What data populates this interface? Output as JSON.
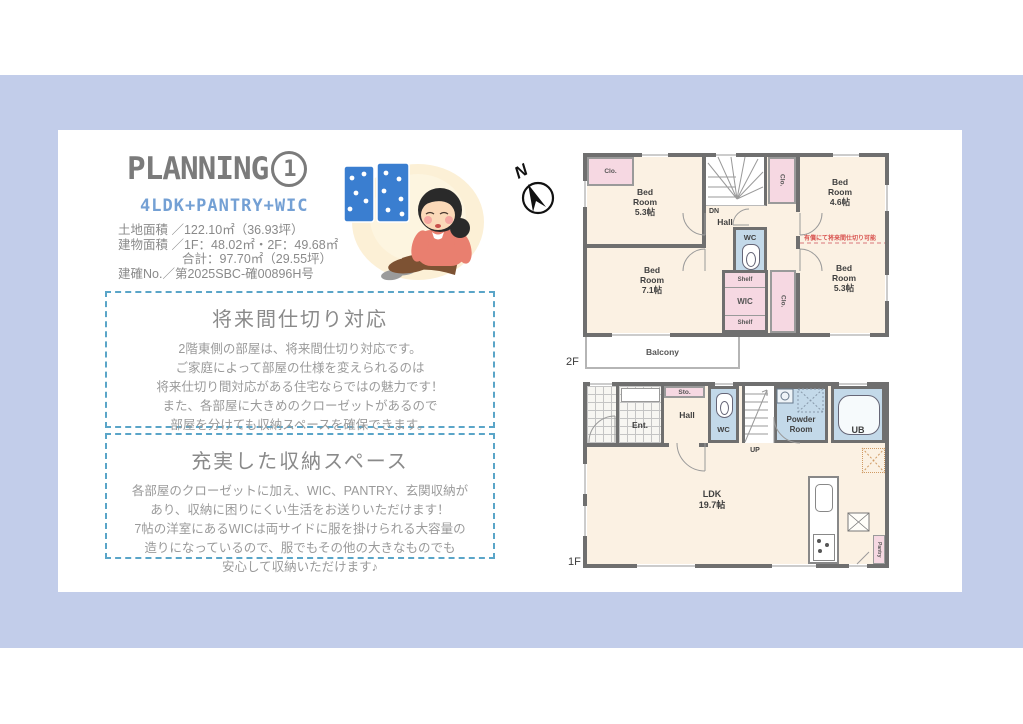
{
  "colors": {
    "frame": "#c2cdea",
    "accent_blue": "#74a0d4",
    "dashed_border": "#5aa5c8",
    "room_cream": "#fbf1e3",
    "closet_pink": "#f6d8e2",
    "wet_area_blue": "#c3d9e9",
    "wall_gray": "#6f6f6f",
    "note_red": "#d9534f"
  },
  "header": {
    "title": "PLANNING",
    "title_number": "1",
    "subtitle": "4LDK+PANTRY+WIC",
    "spec_line1": "土地面積 ／122.10㎡（36.93坪）",
    "spec_line2": "建物面積 ／1F：48.02㎡・2F：49.68㎡",
    "spec_line3": "合計：97.70㎡（29.55坪）",
    "spec_line4": "建確No.／第2025SBC-確00896H号"
  },
  "boxes": [
    {
      "title": "将来間仕切り対応",
      "lines": [
        "2階東側の部屋は、将来間仕切り対応です。",
        "ご家庭によって部屋の仕様を変えられるのは",
        "将来仕切り間対応がある住宅ならではの魅力です！",
        "また、各部屋に大きめのクローゼットがあるので",
        "部屋を分けても収納スペースを確保できます。"
      ]
    },
    {
      "title": "充実した収納スペース",
      "lines": [
        "各部屋のクローゼットに加え、WIC、PANTRY、玄関収納が",
        "あり、収納に困りにくい生活をお送りいただけます！",
        "7帖の洋室にあるWICは両サイドに服を掛けられる大容量の",
        "造りになっているので、服でもその他の大きなものでも",
        "安心して収納いただけます♪"
      ]
    }
  ],
  "compass": {
    "north": "N"
  },
  "floor2": {
    "floor_label": "2F",
    "clo_tl": "Clo.",
    "bed_tl_name": "Bed Room",
    "bed_tl_size": "5.3帖",
    "stairs_dn": "DN",
    "clo_top": "Clo.",
    "bed_tr_name": "Bed Room",
    "bed_tr_size": "4.6帖",
    "hall": "Hall",
    "wc": "WC",
    "partition_note": "有償にて将来間仕切り可能",
    "shelf_top": "Shelf",
    "wic": "WIC",
    "shelf_bottom": "Shelf",
    "clo_bottom": "Clo.",
    "bed_bl_name": "Bed Room",
    "bed_bl_size": "7.1帖",
    "bed_br_name": "Bed Room",
    "bed_br_size": "5.3帖",
    "balcony": "Balcony"
  },
  "floor1": {
    "floor_label": "1F",
    "ent": "Ent.",
    "sto": "Sto.",
    "hall": "Hall",
    "wc": "WC",
    "up": "UP",
    "powder_name": "Powder Room",
    "ub": "UB",
    "ldk_name": "LDK",
    "ldk_size": "19.7帖",
    "pantry": "Pantry"
  }
}
